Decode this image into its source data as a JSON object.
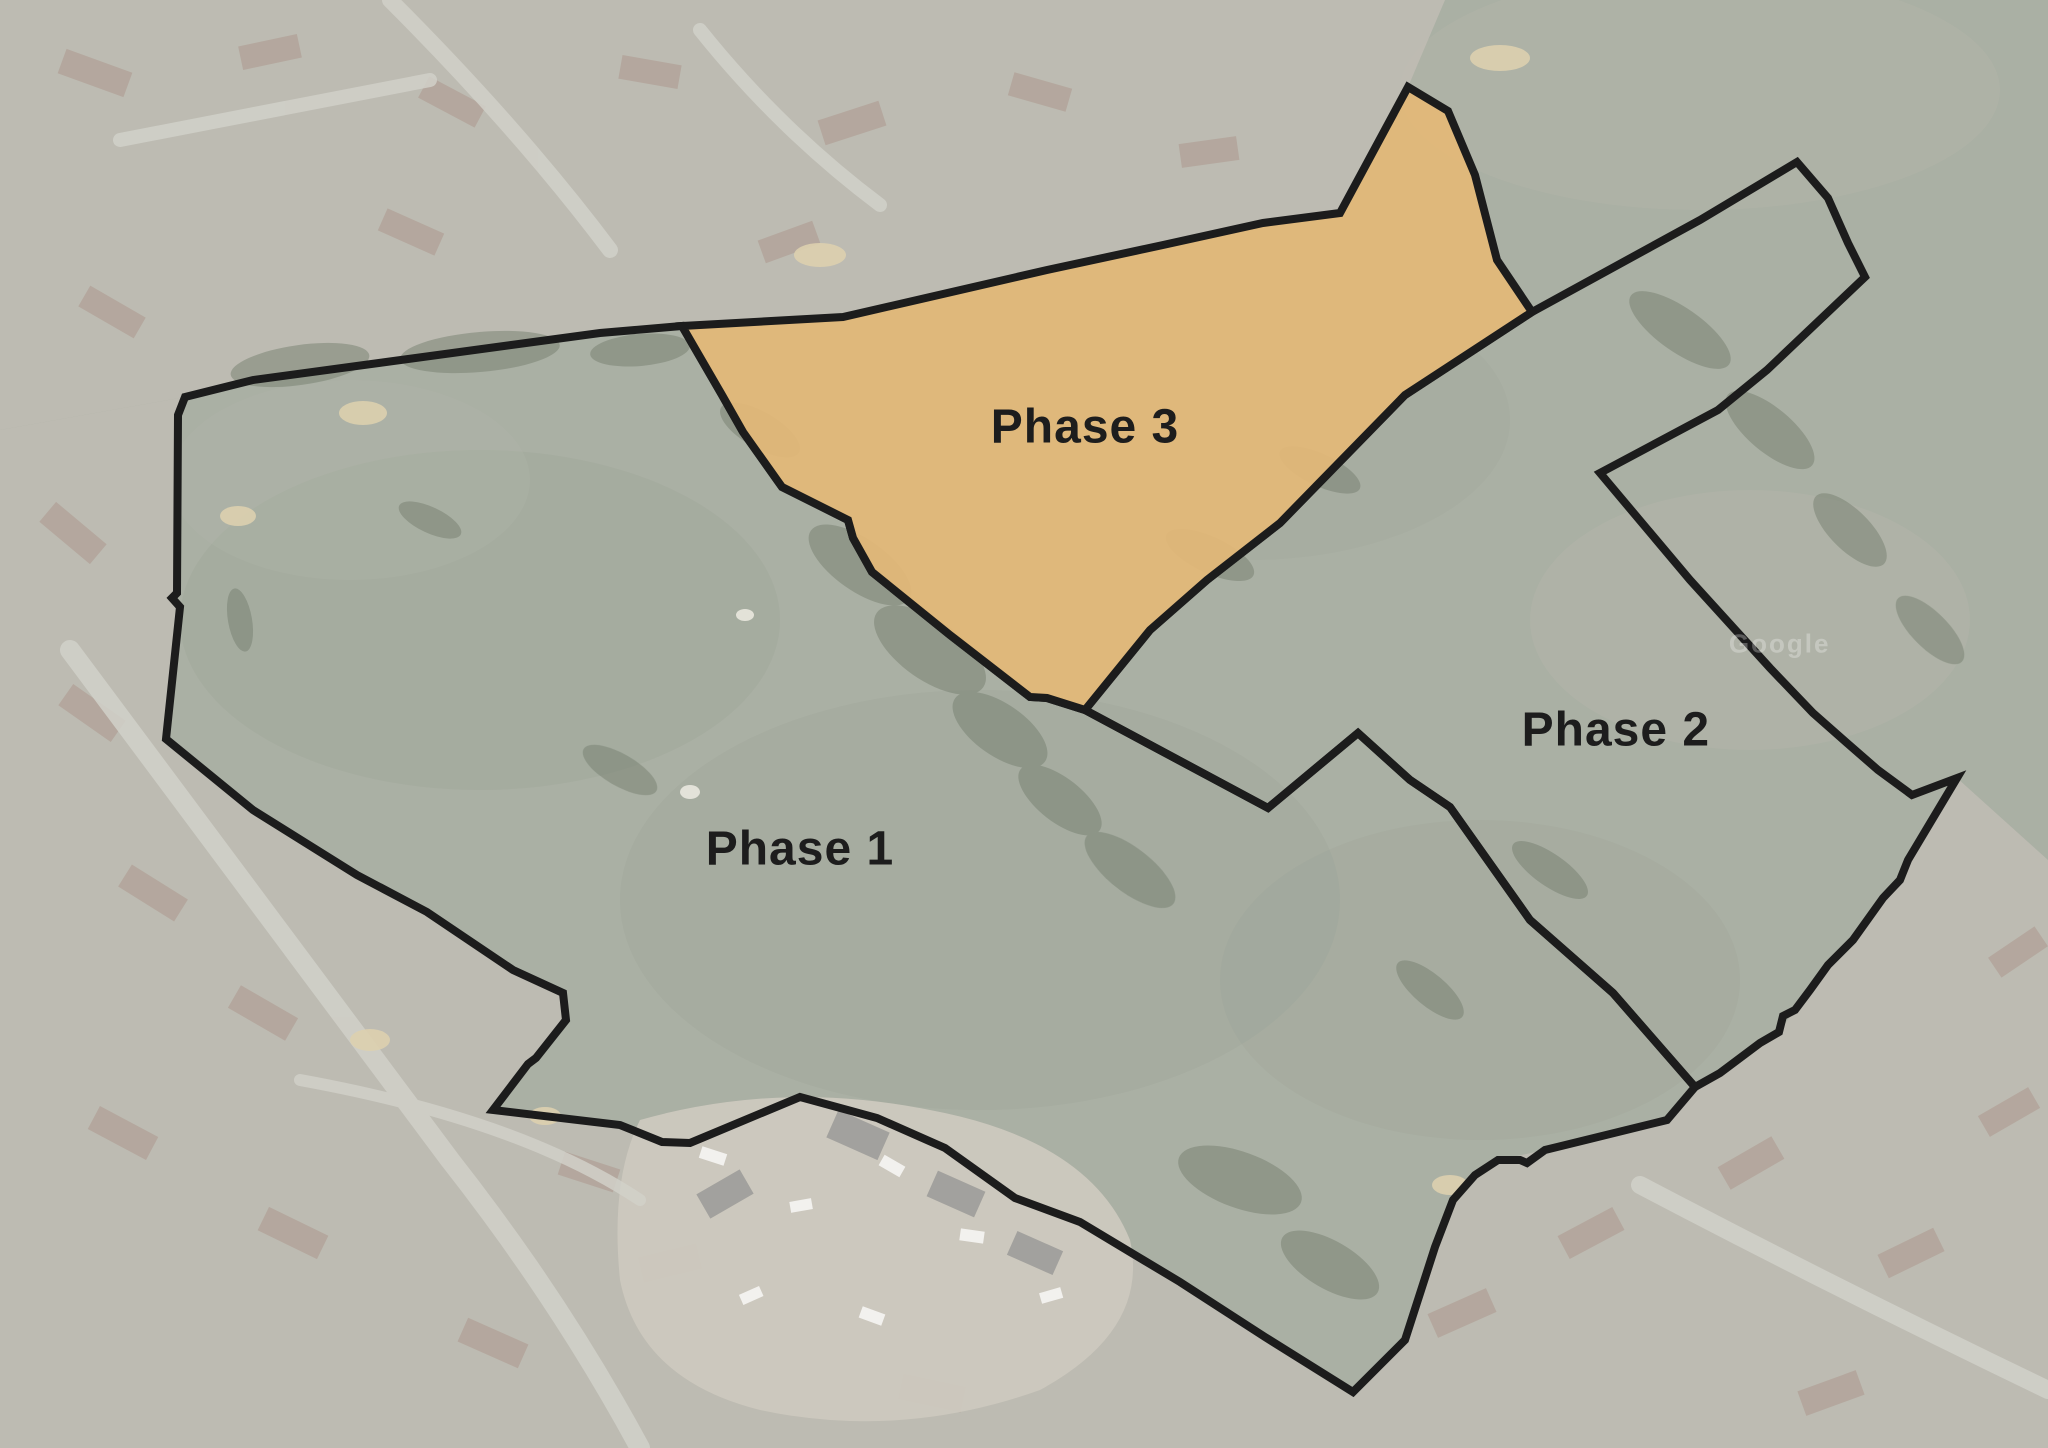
{
  "map": {
    "watermark": "Google",
    "boundary_color": "#1c1c1c",
    "boundary_width": "8",
    "palette": {
      "field": "#a1a79a",
      "field_shade": "#8d9687",
      "field_light": "#aeb2a2",
      "urban": "#b7b4ab",
      "trees": "#66715f",
      "road": "#cdccc4",
      "sand": "#d8cba6",
      "construction": "#c8c3b7",
      "roof": "#a3897c"
    }
  },
  "phases": [
    {
      "id": "phase-1",
      "label": "Phase 1",
      "fill": "none",
      "points": "185,397 253,380 600,333 682,326 722,395 743,432 777,480 782,487 848,520 853,538 872,572 950,635 1030,697 1047,698 1085,710 1268,808 1358,733 1410,780 1450,807 1530,920 1613,993 1695,1087 1667,1120 1545,1150 1527,1163 1520,1160 1498,1160 1475,1175 1453,1200 1435,1247 1405,1340 1353,1392 1265,1337 1180,1282 1080,1222 1015,1198 945,1148 877,1118 800,1097 690,1143 662,1142 620,1125 493,1110 528,1064 536,1058 566,1020 563,993 513,970 427,912 357,875 253,810 166,739 168,720 180,607 172,598 177,593 178,415"
    },
    {
      "id": "phase-2",
      "label": "Phase 2",
      "fill": "none",
      "points": "1085,710 1150,630 1207,580 1280,523 1405,395 1532,312 1700,220 1797,162 1828,198 1848,243 1865,277 1767,370 1718,410 1600,473 1690,580 1770,668 1813,713 1847,743 1878,770 1912,795 1957,778 1908,860 1900,880 1883,898 1853,940 1828,965 1810,990 1795,1010 1783,1016 1779,1032 1760,1043 1720,1073 1695,1087 1613,993 1530,920 1450,807 1410,780 1358,733 1268,808"
    },
    {
      "id": "phase-3",
      "label": "Phase 3",
      "fill": "#e4b877",
      "fill_opacity": "0.92",
      "points": "682,326 843,317 930,297 1047,270 1163,245 1263,223 1340,213 1408,87 1448,111 1475,175 1497,260 1532,312 1405,395 1280,523 1207,580 1150,630 1085,710 1047,698 1030,697 950,635 872,572 853,538 848,520 782,487 777,480 743,432 722,395"
    }
  ]
}
